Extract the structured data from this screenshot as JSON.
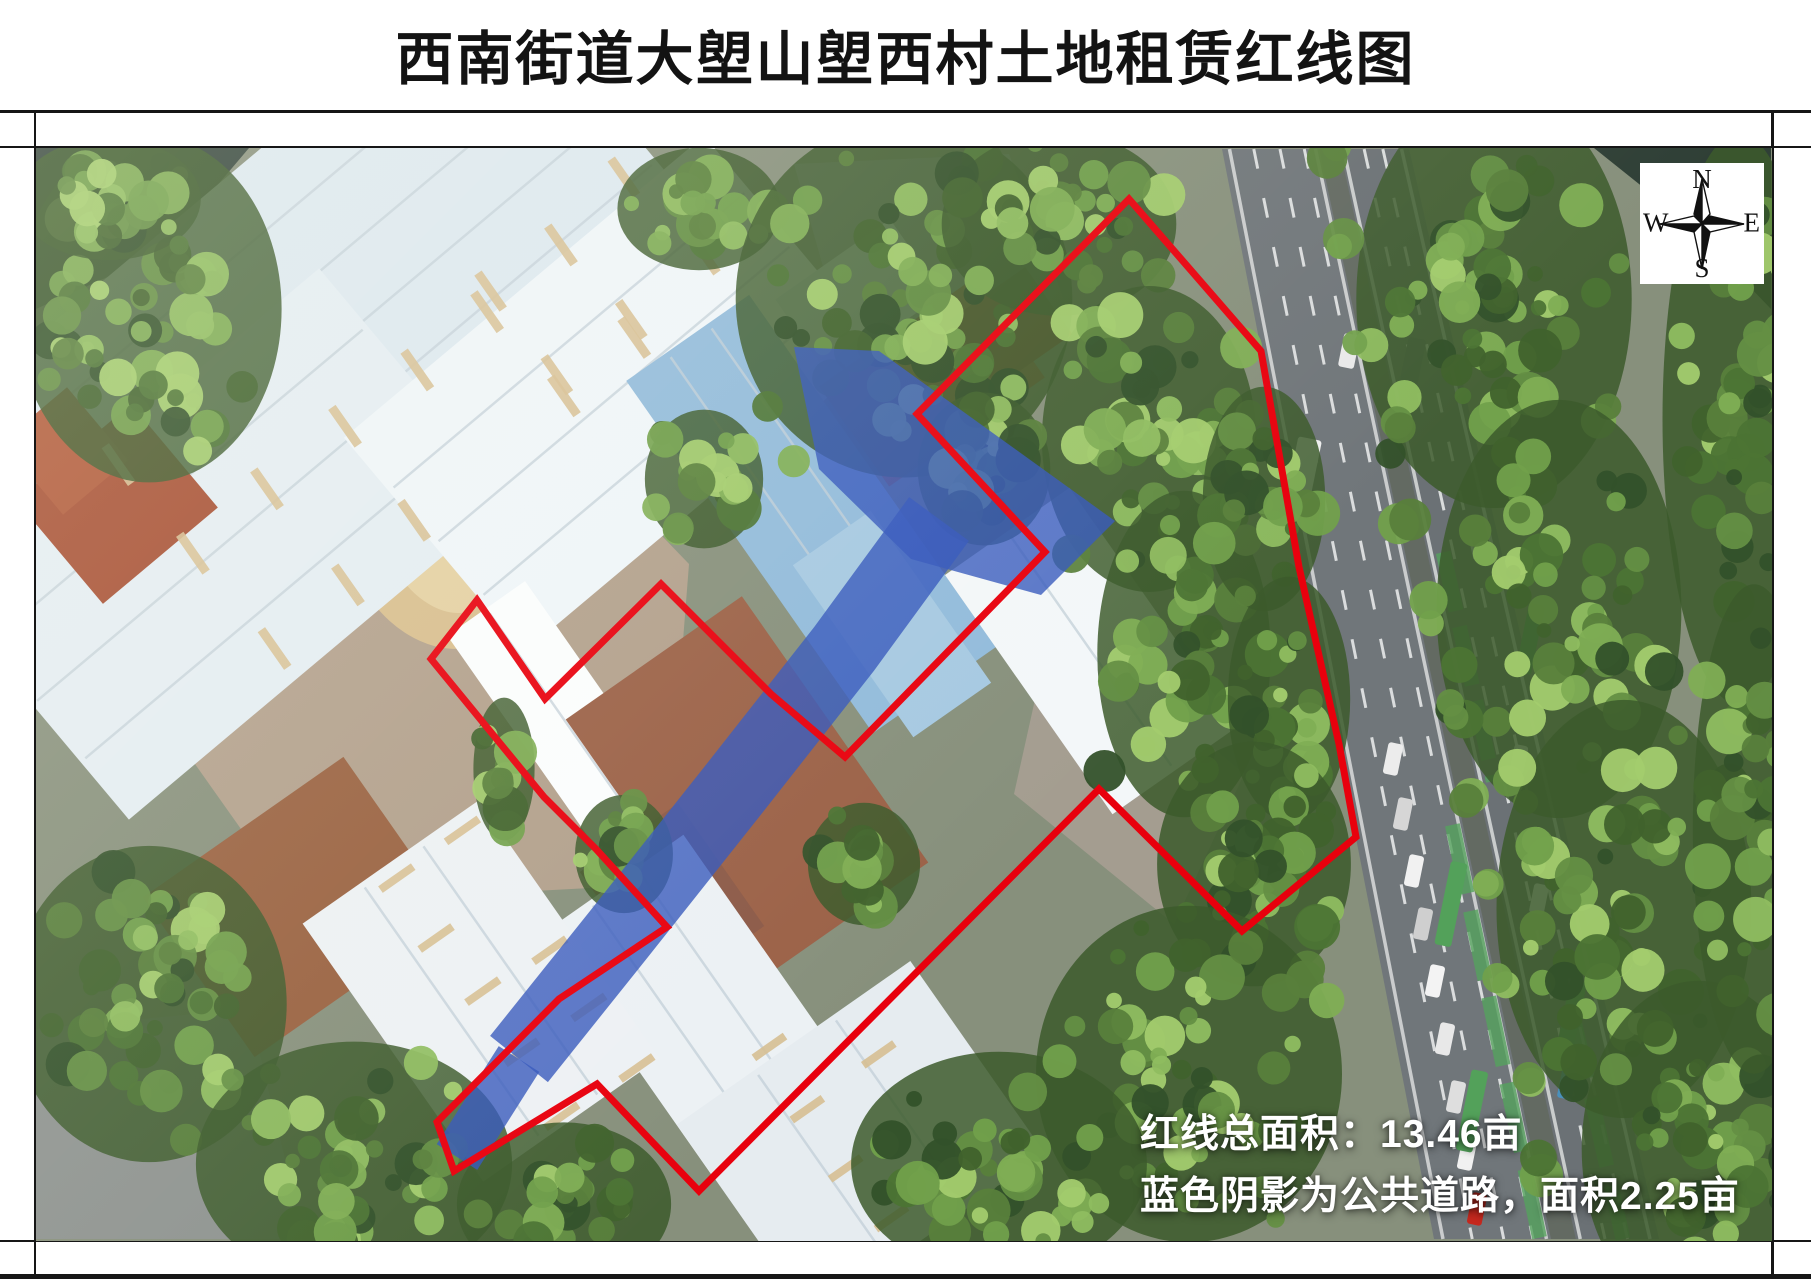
{
  "sheet": {
    "title": "西南街道大塱山塱西村土地租赁红线图"
  },
  "compass": {
    "north": "N",
    "east": "E",
    "south": "S",
    "west": "W"
  },
  "annotation": {
    "line1": "红线总面积：13.46亩",
    "line2": "蓝色阴影为公共道路，面积2.25亩"
  },
  "colors": {
    "red_line": "#e8000d",
    "blue_road": "#3356bb",
    "frame": "#161616",
    "annotation_text": "#ffffff"
  },
  "map_overlays": {
    "red_boundary": [
      [
        1130,
        200
      ],
      [
        1262,
        352
      ],
      [
        1300,
        568
      ],
      [
        1340,
        745
      ],
      [
        1357,
        838
      ],
      [
        1243,
        932
      ],
      [
        1100,
        790
      ],
      [
        700,
        1192
      ],
      [
        598,
        1085
      ],
      [
        455,
        1172
      ],
      [
        438,
        1123
      ],
      [
        560,
        1000
      ],
      [
        668,
        928
      ],
      [
        597,
        850
      ],
      [
        545,
        798
      ],
      [
        432,
        660
      ],
      [
        478,
        601
      ],
      [
        546,
        700
      ],
      [
        662,
        585
      ],
      [
        772,
        695
      ],
      [
        846,
        758
      ],
      [
        1046,
        553
      ],
      [
        918,
        415
      ]
    ],
    "blue_road": {
      "opacity": 0.8,
      "top_patch": [
        [
          795,
          348
        ],
        [
          880,
          352
        ],
        [
          1116,
          522
        ],
        [
          1042,
          596
        ],
        [
          912,
          560
        ],
        [
          820,
          470
        ]
      ],
      "spine": [
        [
          940,
          520
        ],
        [
          845,
          650
        ],
        [
          735,
          790
        ],
        [
          620,
          935
        ],
        [
          520,
          1060
        ]
      ],
      "spine_width": 74,
      "tip": [
        [
          520,
          1060
        ],
        [
          458,
          1158
        ]
      ],
      "tip_width": 48
    }
  }
}
